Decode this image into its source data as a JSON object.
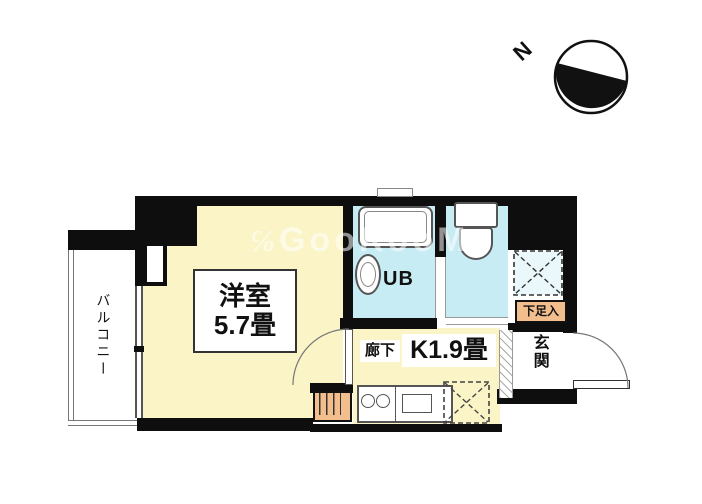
{
  "compass": {
    "north_label": "N"
  },
  "watermark": {
    "prefix": "℅",
    "text": "GooRooM"
  },
  "rooms": {
    "balcony": {
      "label": "バルコニー"
    },
    "western_room": {
      "name": "洋室",
      "size": "5.7畳"
    },
    "unit_bath": {
      "label": "UB"
    },
    "corridor": {
      "label": "廊下"
    },
    "kitchen": {
      "label": "K1.9畳"
    },
    "shoe_cupboard": {
      "label": "下足入"
    },
    "entrance": {
      "label": "玄関"
    }
  },
  "colors": {
    "wall": "#0e0e0e",
    "room_yellow": "#faf4c6",
    "wet_area_cyan": "#c8ecf4",
    "storage_orange": "#f3be8e",
    "watermark_white": "#ffffff"
  }
}
